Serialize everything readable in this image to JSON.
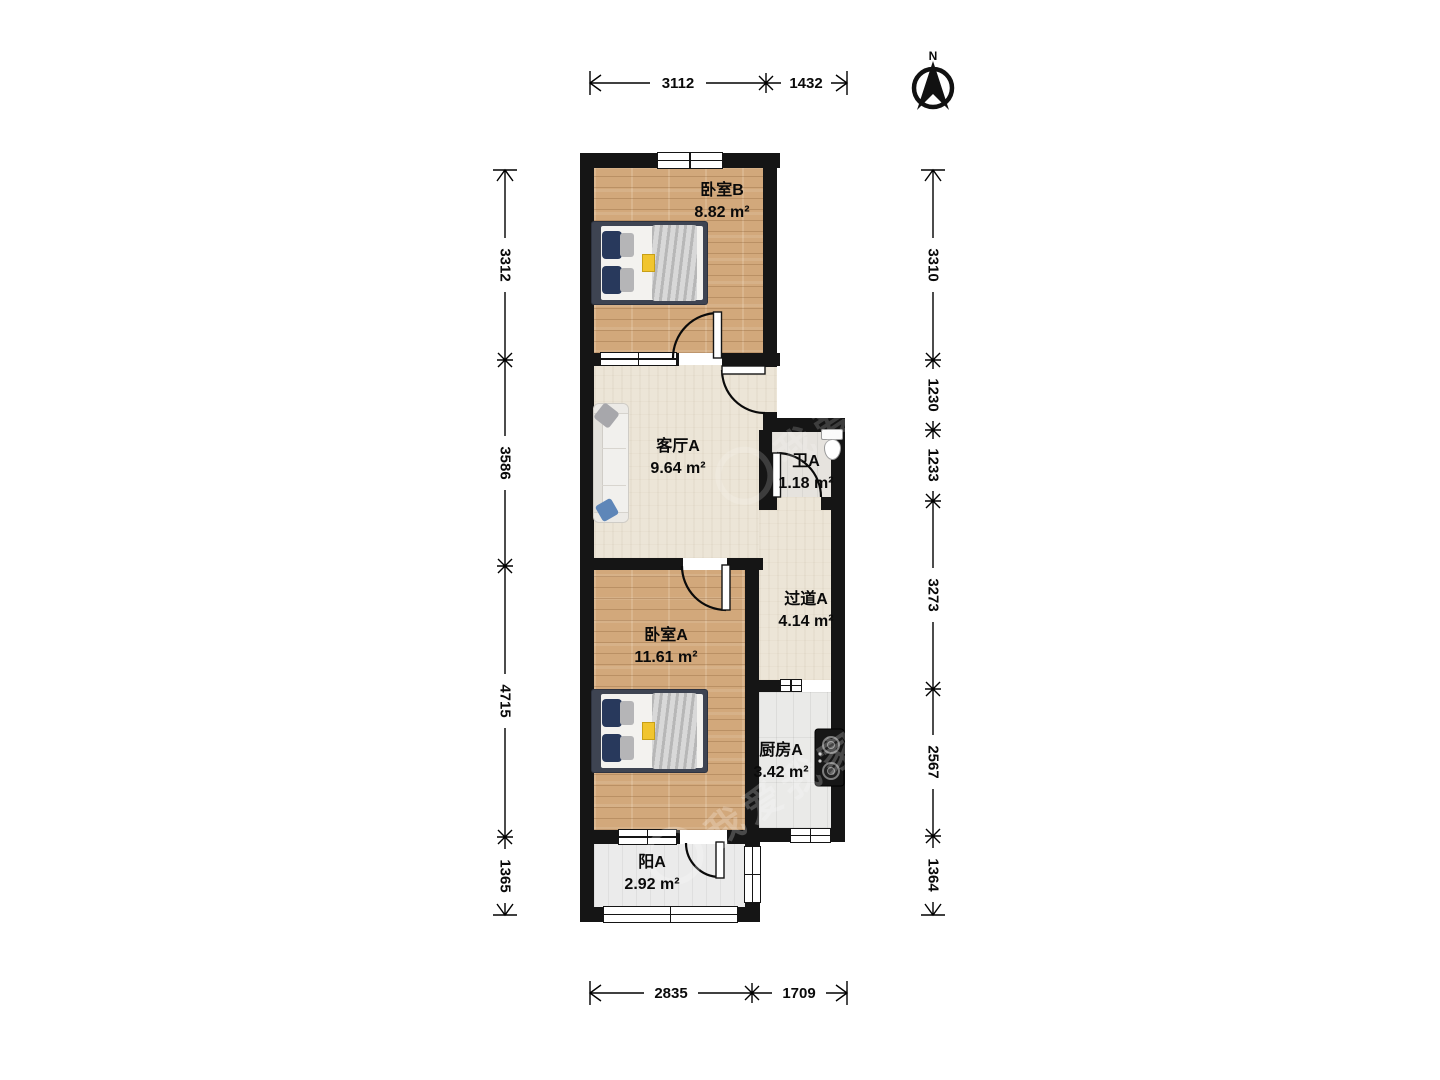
{
  "compass": {
    "north_label": "N"
  },
  "watermark": {
    "text": "我爱我家"
  },
  "rooms": [
    {
      "name": "卧室B",
      "area": "8.82 m²"
    },
    {
      "name": "客厅A",
      "area": "9.64 m²"
    },
    {
      "name": "卫A",
      "area": "1.18 m²"
    },
    {
      "name": "过道A",
      "area": "4.14 m²"
    },
    {
      "name": "卧室A",
      "area": "11.61 m²"
    },
    {
      "name": "厨房A",
      "area": "3.42 m²"
    },
    {
      "name": "阳A",
      "area": "2.92 m²"
    }
  ],
  "dimensions": {
    "top": [
      "3112",
      "1432"
    ],
    "bottom": [
      "2835",
      "1709"
    ],
    "left": [
      "3312",
      "3586",
      "4715",
      "1365"
    ],
    "right": [
      "3310",
      "1230",
      "1233",
      "3273",
      "2567",
      "1364"
    ]
  },
  "colors": {
    "wall": "#151515",
    "wood_floor": "#d2a87b",
    "living_floor": "#ece5d7",
    "accent_yellow": "#f1c52e",
    "pillow_navy": "#28395c",
    "pillow_blue": "#5e86b8"
  }
}
